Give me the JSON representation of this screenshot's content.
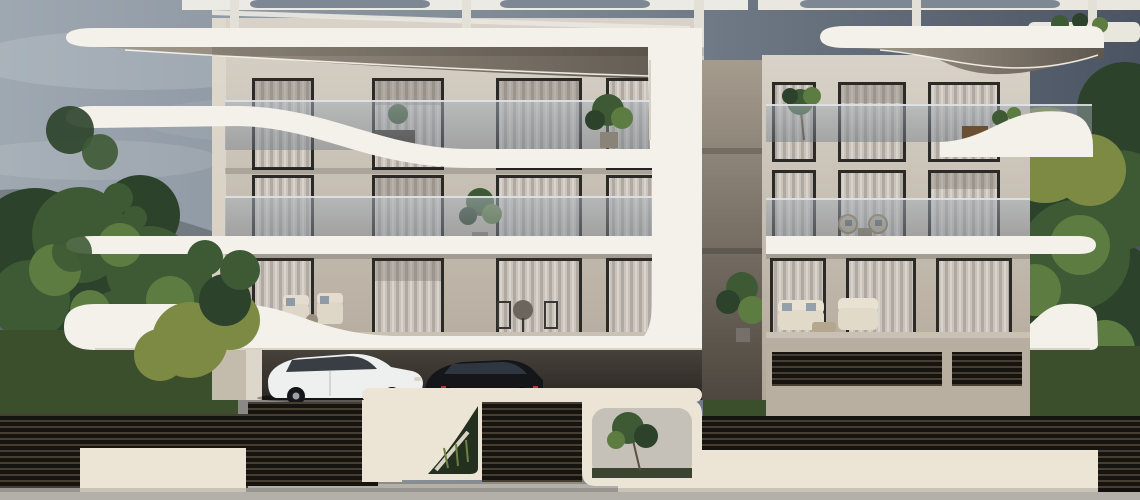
{
  "scene": {
    "type": "3D architectural exterior rendering",
    "subject": "Modern three-storey apartment building with sculptural curved white balcony slabs",
    "conditions": "overcast daytime sky, gray-blue gradient",
    "building": {
      "storeys": 3,
      "features": [
        "rooftop pergola with organic cutouts",
        "curved cantilevered white balcony slabs with rounded ends",
        "recessed LED light strips in dark soffits",
        "frameless glass balustrades",
        "floor-to-ceiling windows with sheer curtains",
        "central sculptural white pier",
        "ground-level carport with parked cars",
        "terraces with outdoor lounge furniture and potted plants"
      ]
    },
    "vehicles": [
      {
        "type": "white SUV",
        "location": "carport"
      },
      {
        "type": "dark SUV",
        "location": "carport"
      }
    ],
    "foreground": [
      "dark horizontal-slatted fence",
      "white boundary wall panels",
      "dark slatted entrance gate with steps behind",
      "wall cutouts with ornamental planting",
      "concrete sidewalk"
    ],
    "landscaping": [
      "mature green trees left and right",
      "yellow-green shrubs",
      "lawn areas",
      "paved walkway"
    ]
  },
  "colors": {
    "sky_left": "#9fa8b1",
    "sky_mid": "#7b8692",
    "sky_right": "#4b5462",
    "cloud": "#ccd2d8",
    "slab_white": "#f4f1ea",
    "slab_edge": "#cfc8bb",
    "facade_light": "#d8d2c8",
    "facade_dark": "#b1a799",
    "soffit_light": "#a59c8e",
    "soffit_dark": "#5f584f",
    "glass_tint": "#aab3bd",
    "glass_deep": "#6f7984",
    "window_frame": "#2b2a27",
    "curtain_light": "#c9c3bb",
    "curtain_mid": "#b0a9a1",
    "interior_dark": "#6e6760",
    "foliage_dark": "#2c422a",
    "foliage_mid": "#3e5a34",
    "foliage_light": "#5d7c42",
    "foliage_yellow": "#7d8a44",
    "grass": "#3c4f2d",
    "trunk": "#4e463c",
    "fence_dark": "#17130f",
    "fence_slat": "#473e33",
    "wall_white": "#ece5d6",
    "pavement": "#8b8985",
    "sidewalk": "#b3b0aa",
    "carport_dark": "#2b2724",
    "car_white": "#eef0ef",
    "car_glass": "#252a31",
    "car_dark": "#15161a",
    "accent_red": "#b23b32",
    "led_strip": "#f8f6ef"
  }
}
